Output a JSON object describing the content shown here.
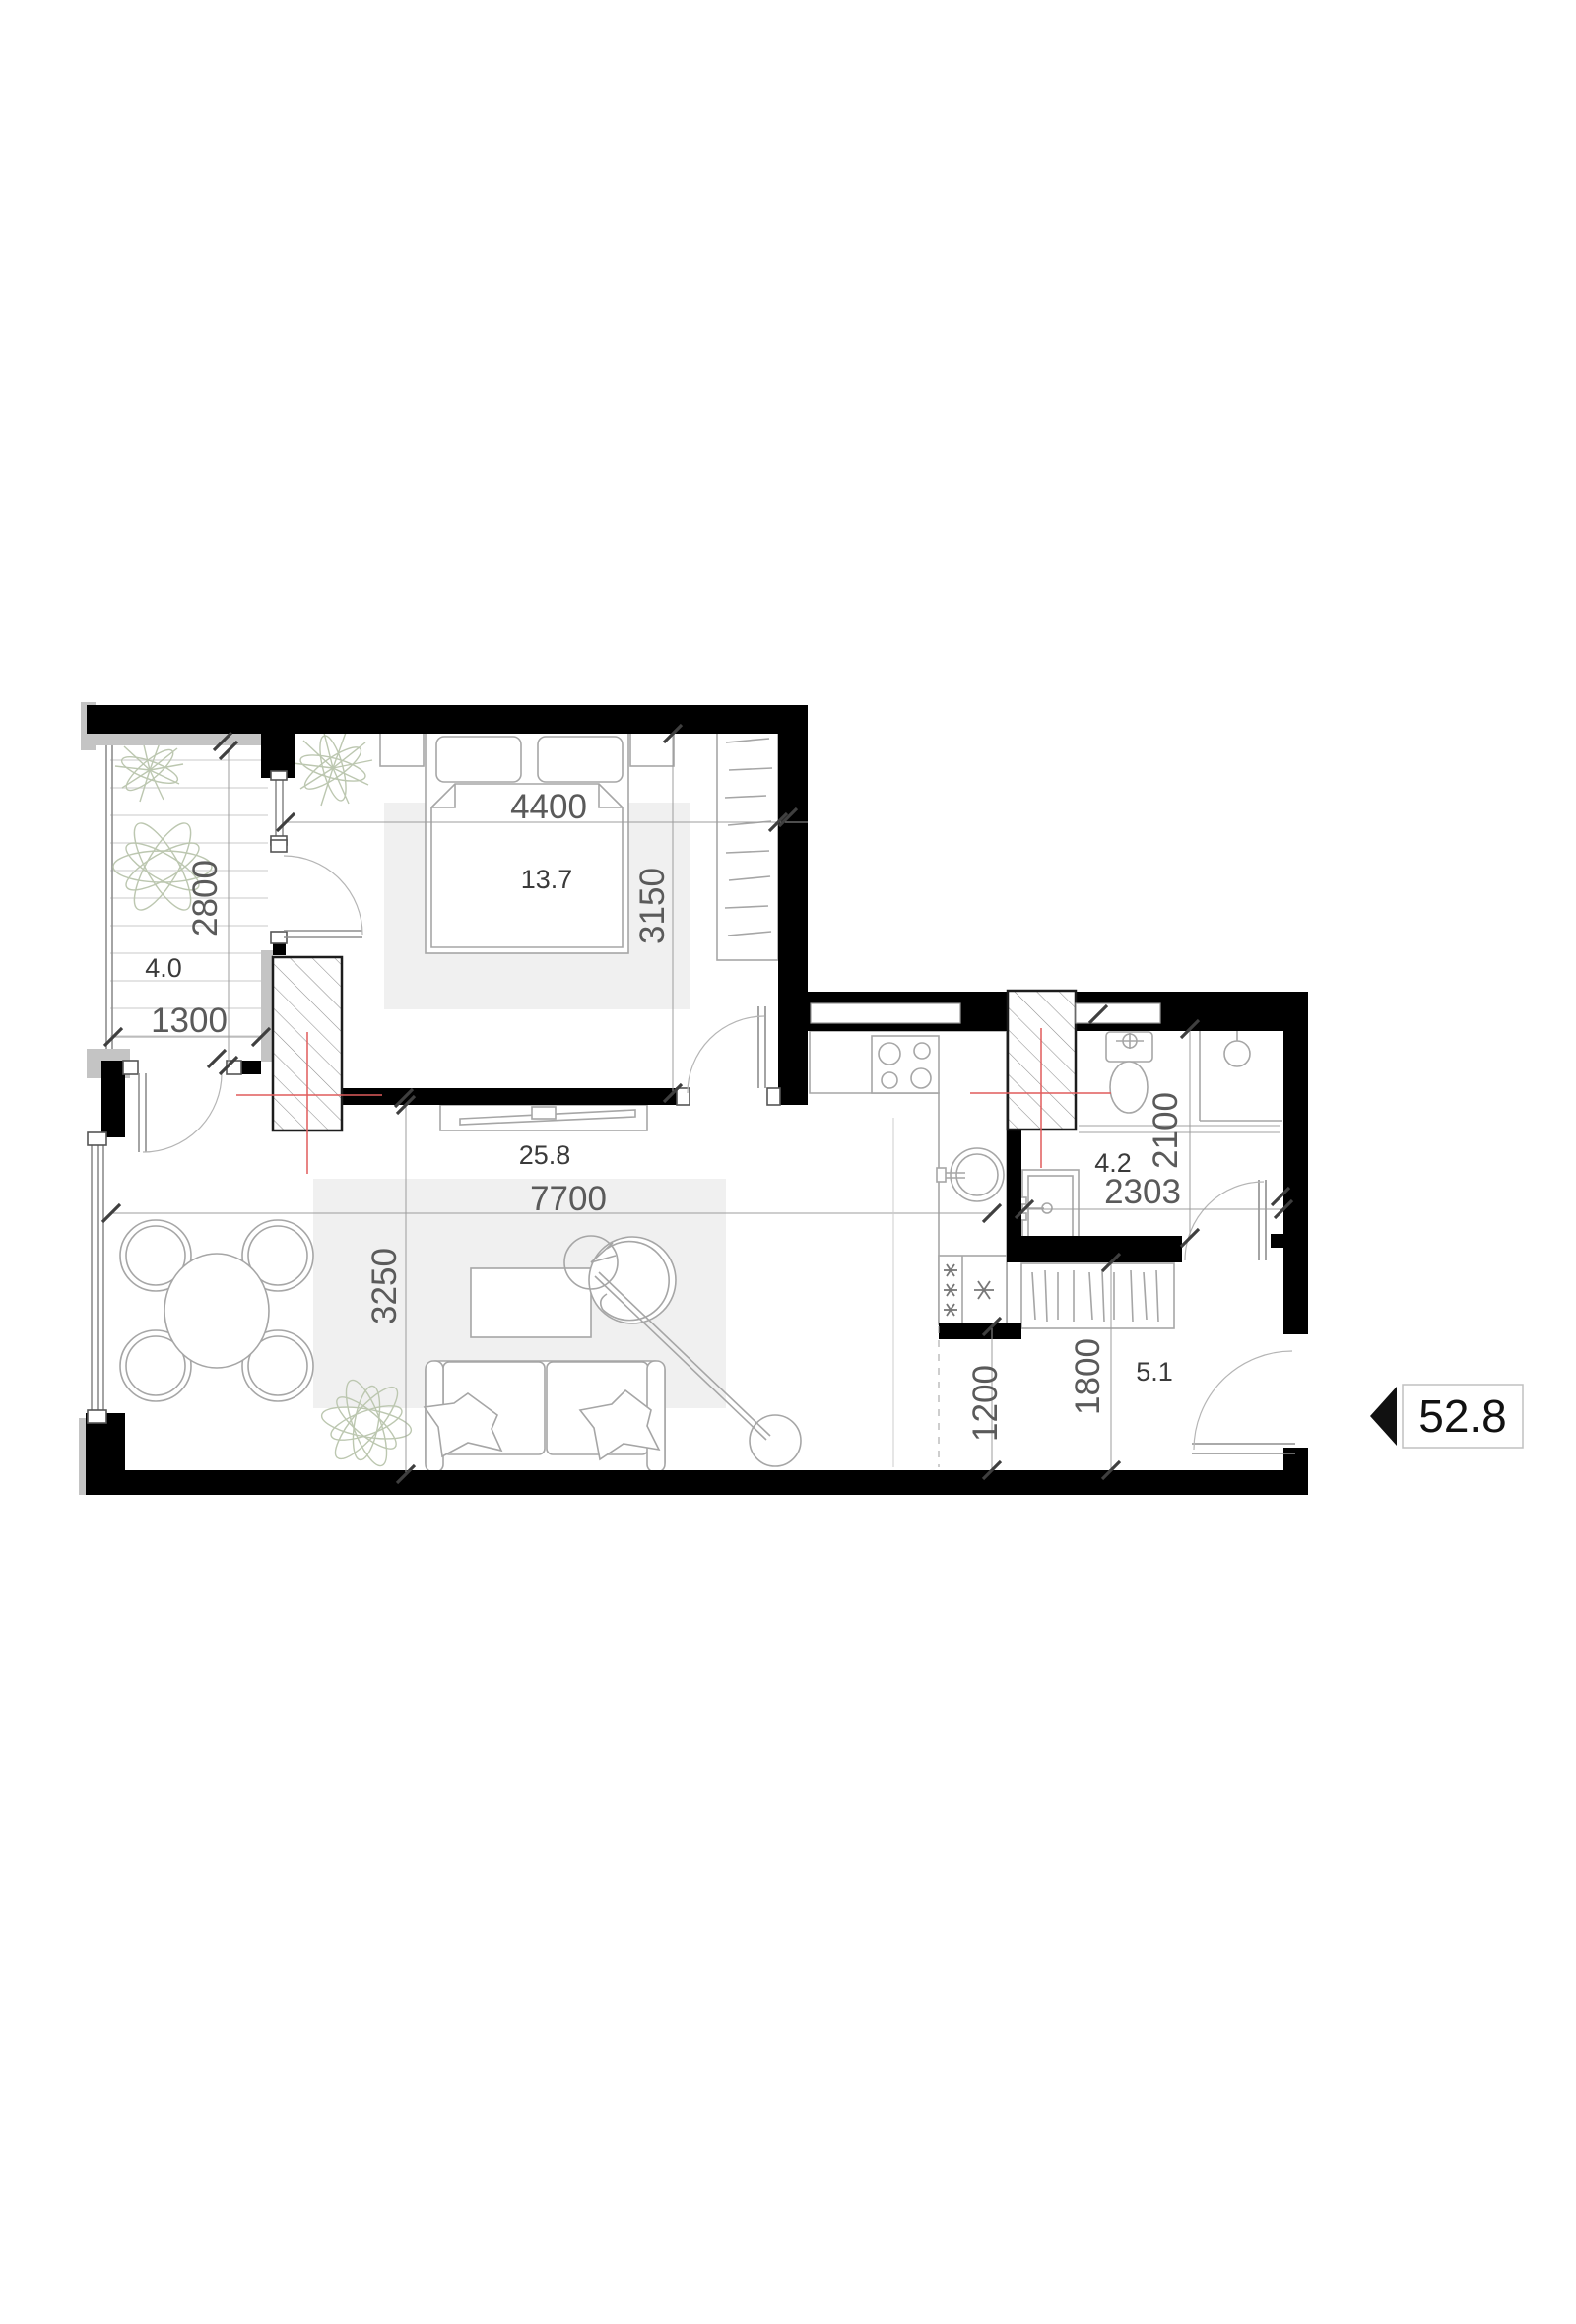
{
  "plan": {
    "total_area": "52.8",
    "rooms": {
      "balcony": {
        "name": "balcony",
        "area": "4.0",
        "dim_width": "1300",
        "dim_height": "2800"
      },
      "bedroom": {
        "name": "bedroom",
        "area": "13.7",
        "dim_width": "4400",
        "dim_height": "3150"
      },
      "living": {
        "name": "living-kitchen",
        "area": "25.8",
        "dim_width": "7700",
        "dim_height": "3250"
      },
      "bathroom": {
        "name": "bathroom",
        "area": "4.2",
        "dim_width": "2303",
        "dim_height": "2100"
      },
      "hallway": {
        "name": "hallway",
        "area": "5.1",
        "dim_passage": "1200",
        "dim_height": "1800"
      }
    },
    "colors": {
      "wall": "#000000",
      "outer_trim": "#c4c4c4",
      "dimension_text": "#5a5a5a",
      "area_text": "#3a3a3a",
      "centerline_red": "#e05c5c",
      "rug": "#f0f0f0",
      "furniture_line": "#a6a6a6",
      "plant_line": "#bcc7b0"
    }
  }
}
